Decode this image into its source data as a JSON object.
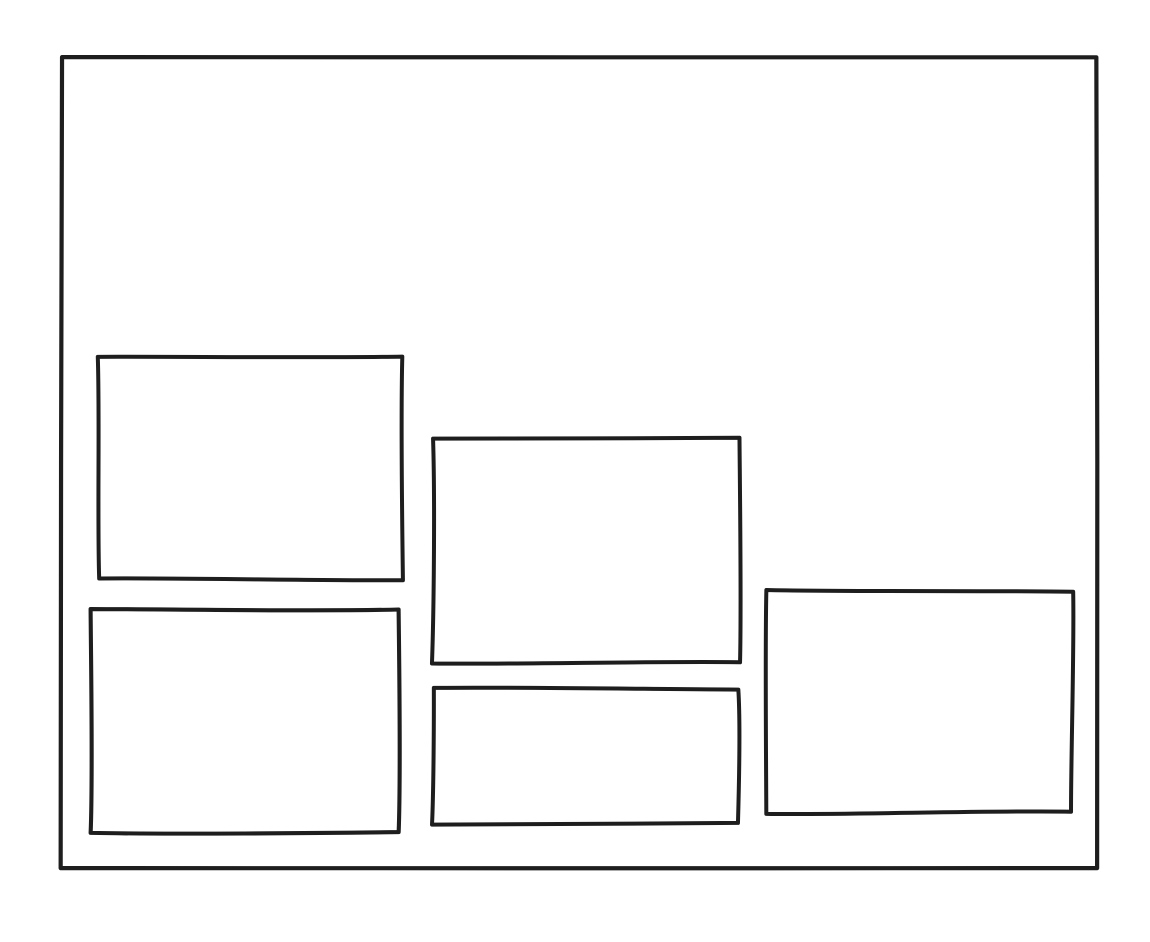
{
  "canvas": {
    "width": 1150,
    "height": 942,
    "background_color": "#ffffff"
  },
  "diagram": {
    "type": "wireframe-sketch",
    "style": "hand-drawn",
    "stroke_color": "#1e1e1e",
    "fill_color": "#ffffff",
    "frame": {
      "name": "outer-frame",
      "x": 62,
      "y": 57,
      "width": 1034,
      "height": 811,
      "stroke_width": 4.2,
      "seed": 11
    },
    "boxes": [
      {
        "name": "box-top-left",
        "x": 98,
        "y": 357,
        "width": 305,
        "height": 222,
        "stroke_width": 4,
        "seed": 21
      },
      {
        "name": "box-middle",
        "x": 433,
        "y": 437,
        "width": 308,
        "height": 225,
        "stroke_width": 4,
        "seed": 37
      },
      {
        "name": "box-bottom-left",
        "x": 92,
        "y": 608,
        "width": 308,
        "height": 224,
        "stroke_width": 4.1,
        "seed": 53
      },
      {
        "name": "box-bottom-middle",
        "x": 433,
        "y": 689,
        "width": 305,
        "height": 135,
        "stroke_width": 4,
        "seed": 71
      },
      {
        "name": "box-right",
        "x": 765,
        "y": 591,
        "width": 307,
        "height": 222,
        "stroke_width": 4,
        "seed": 89
      }
    ]
  }
}
